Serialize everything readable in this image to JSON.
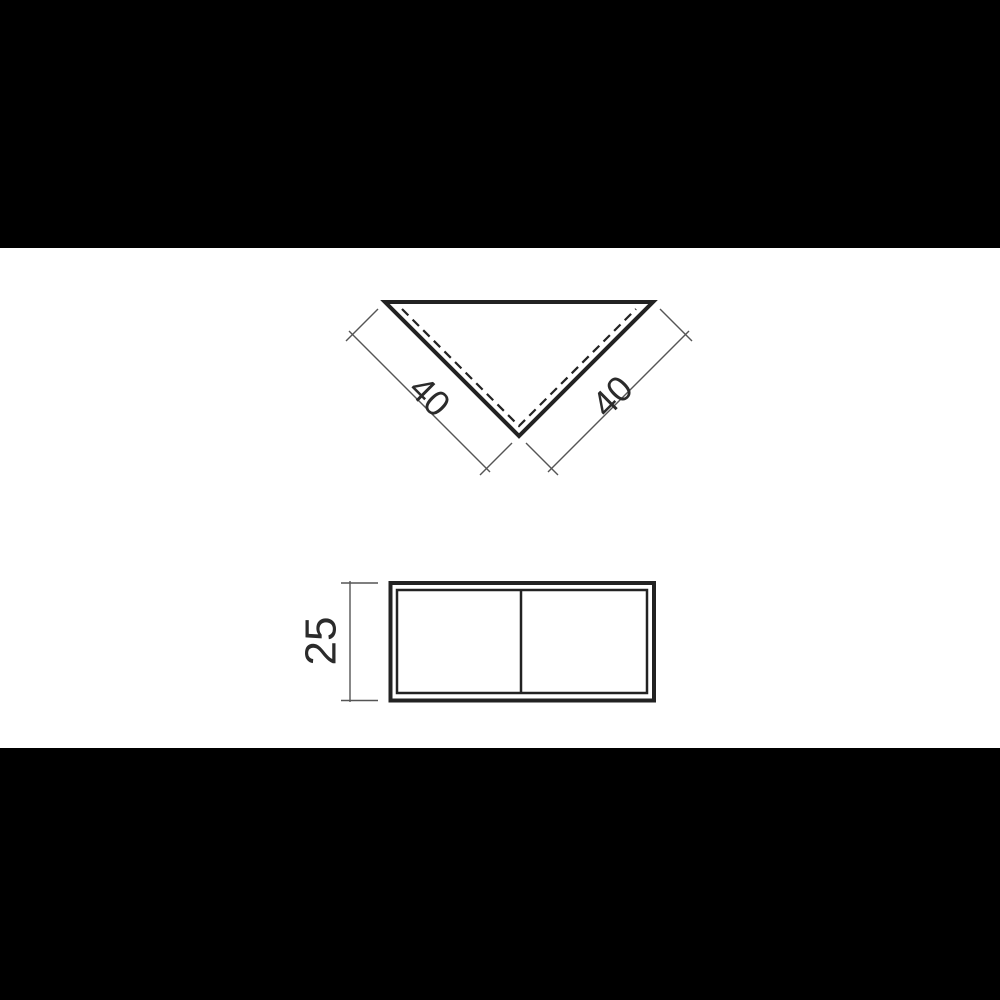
{
  "page": {
    "background": "#000000",
    "canvas": "#ffffff"
  },
  "drawing": {
    "colors": {
      "outline": "#222222",
      "dimension_line": "#555555",
      "text": "#2b2b2b"
    },
    "top_view": {
      "shape": "triangle-point-down",
      "left_dimension_label": "40",
      "right_dimension_label": "40"
    },
    "front_view": {
      "shape": "rectangle-with-divider",
      "height_dimension_label": "25"
    }
  }
}
